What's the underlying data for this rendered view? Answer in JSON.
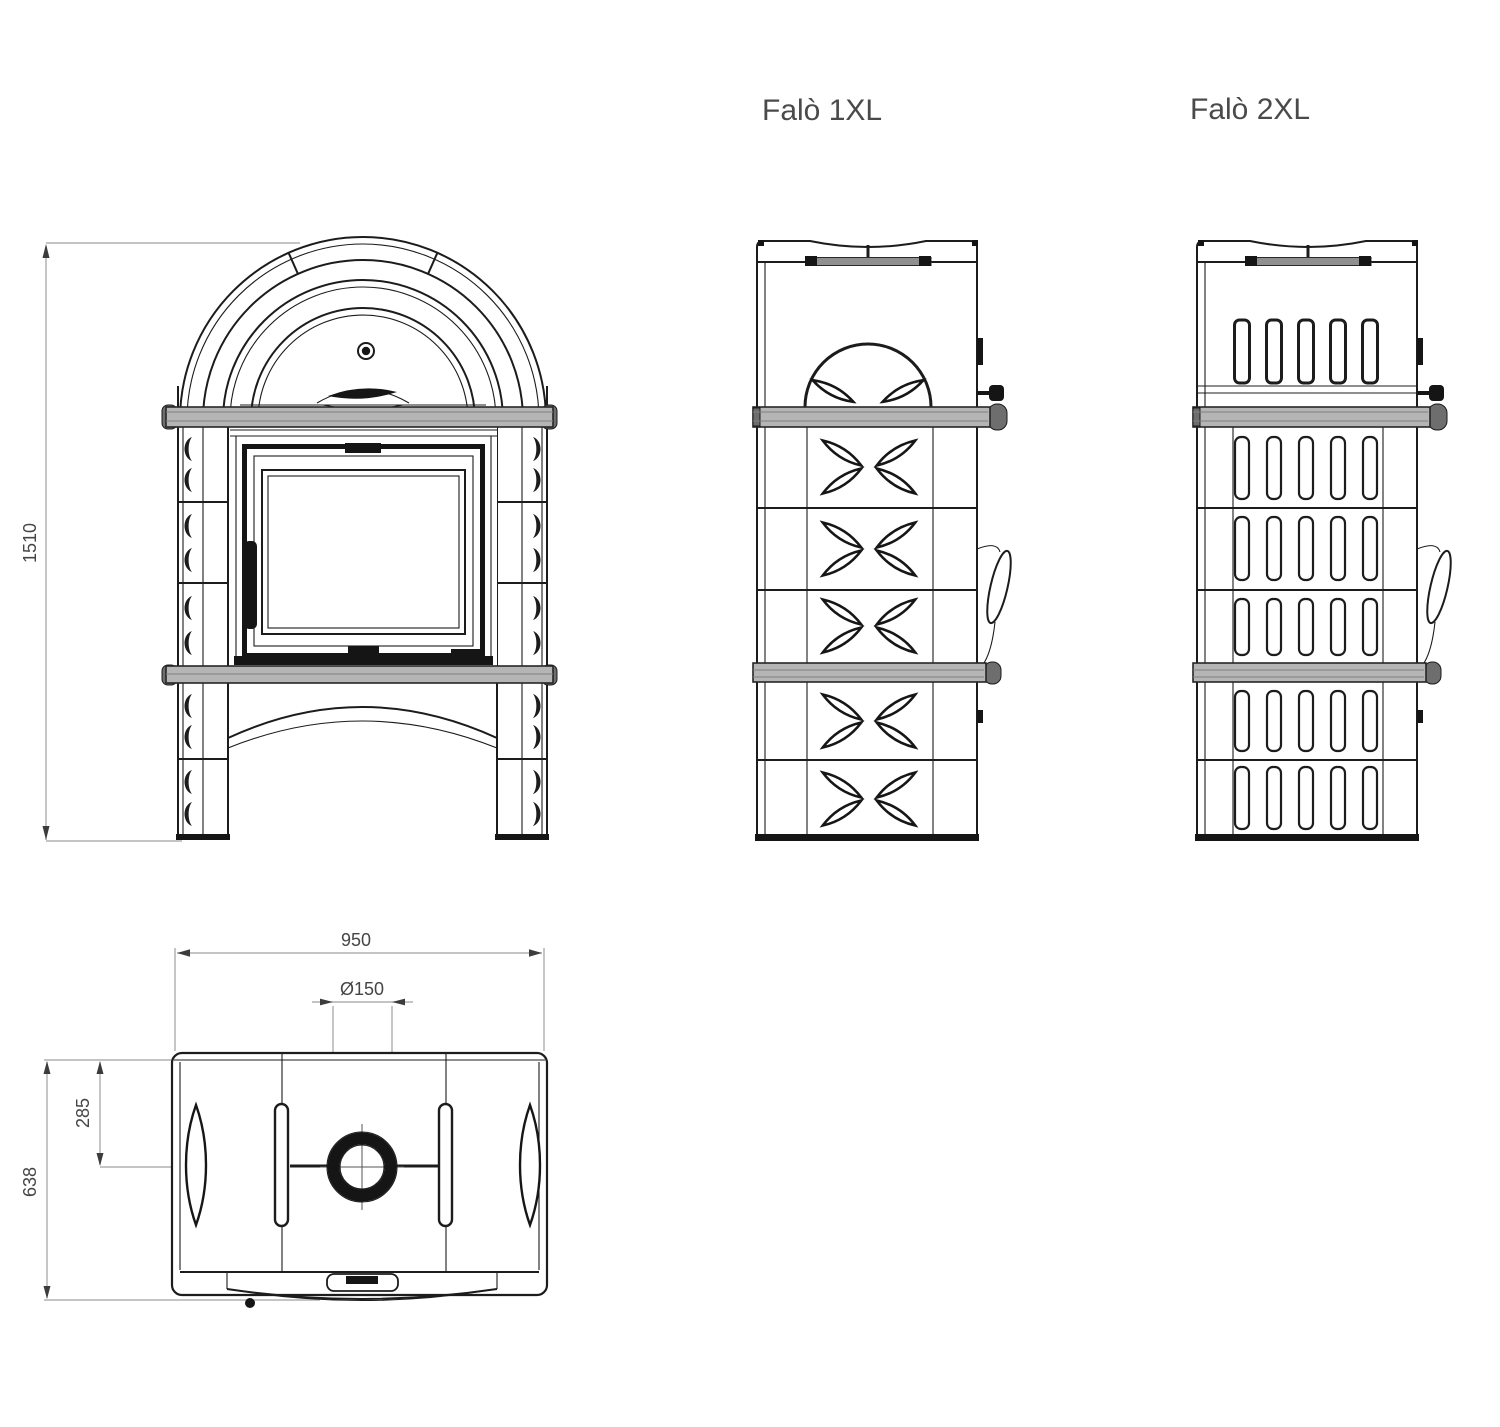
{
  "drawing": {
    "labels": {
      "model_1xl": "Falò 1XL",
      "model_2xl": "Falò 2XL"
    },
    "dimensions": {
      "height": "1510",
      "width": "950",
      "flue_diameter": "Ø150",
      "flue_offset": "285",
      "depth": "638"
    },
    "colors": {
      "line": "#1c1c1c",
      "dimension_line": "#a0a0a0",
      "dimension_text": "#454545",
      "label_text": "#4a4a4a",
      "shelf_fill": "#b5b5b5",
      "metal_bar": "#8f8f8f",
      "background": "#ffffff"
    }
  }
}
